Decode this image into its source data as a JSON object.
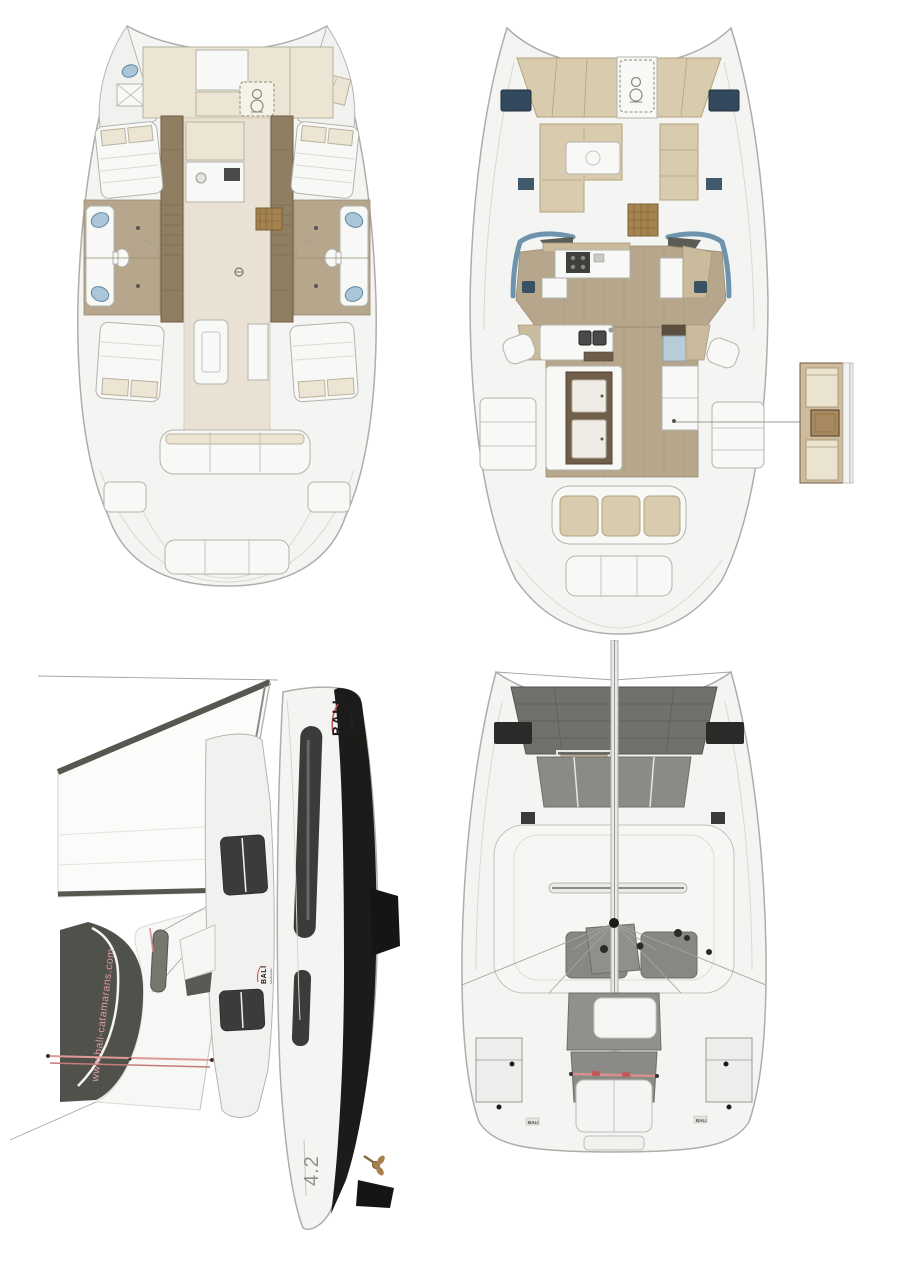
{
  "branding": {
    "logo_text": "BALI",
    "logo_subtext": "catamarans",
    "hull_logo_text": "BALI",
    "hull_logo_subtext": "catamarans",
    "website_text": "www.bali-catamarans.com",
    "model_text": "4.2",
    "deck_mark_port_text": "BALI",
    "deck_mark_starboard_text": "BALI",
    "logo_color": "#1c1c1c",
    "swoosh_color": "#c0504d",
    "website_text_color": "#d99d9d",
    "model_text_color": "#8f8f8c",
    "deck_mark_color": "#4a4a48"
  },
  "colors": {
    "background": "#ffffff",
    "hull_fill": "#f4f4f2",
    "hull_outline": "#adadaa",
    "cream_furniture": "#ece5d3",
    "tan_cushion": "#d9cbae",
    "wood_floor": "#b6a68b",
    "wood_bulkhead": "#907e62",
    "walnut_cabinet": "#6f5e49",
    "rattan_mat": "#a5834f",
    "hatch_navy": "#33495d",
    "windshield_blue": "#6d93ad",
    "sink_blue": "#aac6d9",
    "glass_cooler": "#b7ccd8",
    "sail_white": "#fbfbfa",
    "sail_band_gray": "#57574f",
    "hull_black": "#1b1b19",
    "window_dark": "#3b3b39",
    "deck_gray": "#8a8a86",
    "trampoline_gray": "#70706c",
    "rigging_red": "#e09a98",
    "bronze_prop": "#a97f4f"
  },
  "icons": {
    "windlass": "stacked double circle in dashed locker lid",
    "mast_foot": "filled black circle",
    "winch": "small filled dot",
    "sink_basin": "blue oval",
    "propeller": "bronze hub with blades"
  }
}
